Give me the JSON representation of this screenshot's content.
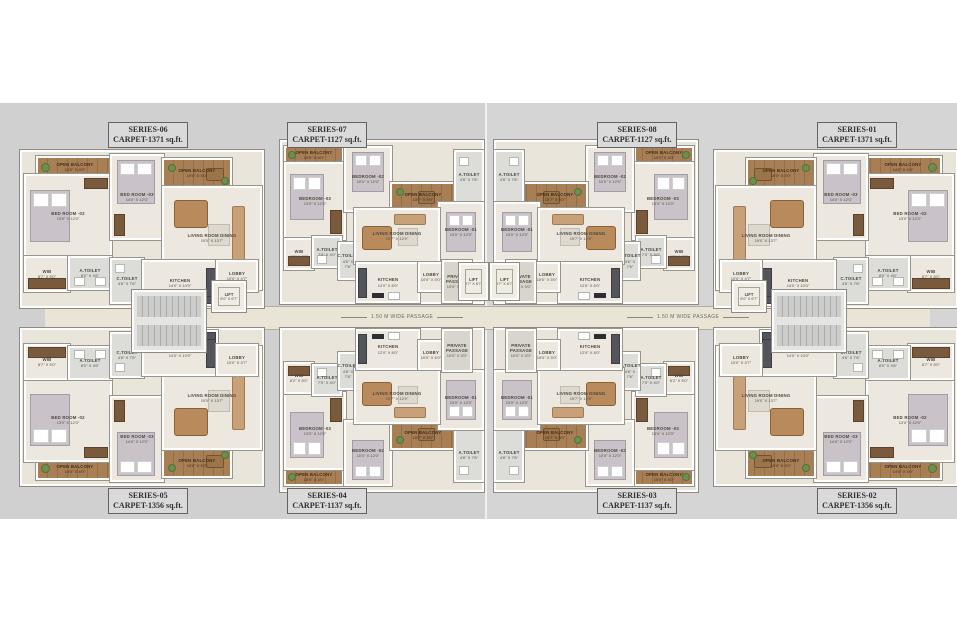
{
  "palette": {
    "page_bg": "#ffffff",
    "canvas_left": "#d0d0d0",
    "canvas_right": "#d5d5d5",
    "floor": "#ece8df",
    "wood_balcony": "#a87e55",
    "corridor": "#e9e4d6",
    "counter_dark": "#53555a",
    "wall": "#fdfdfd",
    "label_text": "#4c483e"
  },
  "passage": {
    "label": "1.50 M WIDE PASSAGE"
  },
  "cores": {
    "lift": {
      "name": "LIFT",
      "dims": "8'0\" X 6'7\""
    },
    "lift_center": {
      "name": "LIFT",
      "dims": "8'7\" X 6'7\""
    }
  },
  "units": [
    {
      "series": "SERIES-06",
      "carpet": "CARPET-1371 sq.ft.",
      "type": "A",
      "flip": "",
      "ux": 20,
      "uy": 150,
      "lx": 108,
      "ly": 122
    },
    {
      "series": "SERIES-07",
      "carpet": "CARPET-1127 sq.ft.",
      "type": "B",
      "flip": "",
      "ux": 280,
      "uy": 140,
      "lx": 287,
      "ly": 122
    },
    {
      "series": "SERIES-08",
      "carpet": "CARPET-1127 sq.ft.",
      "type": "B",
      "flip": "fx",
      "ux": 494,
      "uy": 140,
      "lx": 597,
      "ly": 122
    },
    {
      "series": "SERIES-01",
      "carpet": "CARPET-1371 sq.ft.",
      "type": "A",
      "flip": "fx",
      "ux": 714,
      "uy": 150,
      "lx": 817,
      "ly": 122
    },
    {
      "series": "SERIES-05",
      "carpet": "CARPET-1356 sq.ft.",
      "type": "A",
      "flip": "fy",
      "ux": 20,
      "uy": 328,
      "lx": 108,
      "ly": 488
    },
    {
      "series": "SERIES-04",
      "carpet": "CARPET-1137 sq.ft.",
      "type": "B",
      "flip": "fy",
      "ux": 280,
      "uy": 328,
      "lx": 287,
      "ly": 488
    },
    {
      "series": "SERIES-03",
      "carpet": "CARPET-1137 sq.ft.",
      "type": "B",
      "flip": "fx fy",
      "ux": 494,
      "uy": 328,
      "lx": 597,
      "ly": 488
    },
    {
      "series": "SERIES-02",
      "carpet": "CARPET-1356 sq.ft.",
      "type": "A",
      "flip": "fx fy",
      "ux": 714,
      "uy": 328,
      "lx": 817,
      "ly": 488
    }
  ],
  "unit_types": {
    "A": {
      "w": 240,
      "h": 154,
      "rooms": [
        {
          "n": "OPEN BALCONY",
          "d": "14'0\" X 4'0\"",
          "x": 14,
          "y": 4,
          "w": 74,
          "h": 18,
          "k": "w",
          "f": [
            {
              "k": "plant",
              "x": 3,
              "y": 5,
              "w": 7,
              "h": 7
            }
          ]
        },
        {
          "n": "BED ROOM -02",
          "d": "13'0\" X 12'0\"",
          "x": 2,
          "y": 22,
          "w": 84,
          "h": 80,
          "k": "t",
          "f": [
            {
              "k": "bed",
              "x": 4,
              "y": 14,
              "w": 40,
              "h": 52
            },
            {
              "k": "ward",
              "x": 58,
              "y": 2,
              "w": 22,
              "h": 9
            }
          ]
        },
        {
          "n": "BED ROOM -03",
          "d": "14'0\" X 12'0\"",
          "x": 88,
          "y": 2,
          "w": 50,
          "h": 82,
          "k": "t",
          "f": [
            {
              "k": "bed",
              "x": 5,
              "y": 4,
              "w": 38,
              "h": 44
            },
            {
              "k": "ward",
              "x": 2,
              "y": 58,
              "w": 9,
              "h": 20
            }
          ]
        },
        {
          "n": "OPEN BALCONY",
          "d": "19'0\" X 5'0\"",
          "x": 140,
          "y": 6,
          "w": 66,
          "h": 26,
          "k": "w",
          "f": [
            {
              "k": "plant",
              "x": 4,
              "y": 4,
              "w": 6,
              "h": 6
            },
            {
              "k": "table2",
              "x": 42,
              "y": 8,
              "w": 16,
              "h": 11
            },
            {
              "k": "plant",
              "x": 57,
              "y": 17,
              "w": 6,
              "h": 6
            }
          ]
        },
        {
          "n": "LIVING ROOM DINING",
          "d": "19'0\" X 13'7\"",
          "x": 140,
          "y": 34,
          "w": 96,
          "h": 100,
          "k": "t",
          "f": [
            {
              "k": "dining",
              "x": 10,
              "y": 12,
              "w": 32,
              "h": 26
            },
            {
              "k": "sofa",
              "x": 68,
              "y": 18,
              "w": 11,
              "h": 54
            },
            {
              "k": "rug",
              "x": 44,
              "y": 36,
              "w": 20,
              "h": 20
            }
          ]
        },
        {
          "n": "WIB",
          "d": "8'7\" X 5'0\"",
          "x": 2,
          "y": 104,
          "w": 42,
          "h": 32,
          "k": "t",
          "f": [
            {
              "k": "ward",
              "x": 2,
              "y": 20,
              "w": 36,
              "h": 9
            }
          ]
        },
        {
          "n": "A.TOILET",
          "d": "8'0\" X 4'6\"",
          "x": 46,
          "y": 104,
          "w": 40,
          "h": 30,
          "k": "s",
          "f": [
            {
              "k": "fix",
              "x": 4,
              "y": 19,
              "w": 9,
              "h": 7
            },
            {
              "k": "fix",
              "x": 25,
              "y": 19,
              "w": 9,
              "h": 7
            }
          ]
        },
        {
          "n": "C.TOILET",
          "d": "4'6\" X 7'6\"",
          "x": 88,
          "y": 106,
          "w": 30,
          "h": 42,
          "k": "s",
          "f": [
            {
              "k": "fix",
              "x": 3,
              "y": 4,
              "w": 8,
              "h": 7
            }
          ]
        },
        {
          "n": "KITCHEN",
          "d": "14'0\" X 10'0\"",
          "x": 120,
          "y": 108,
          "w": 72,
          "h": 42,
          "k": "t",
          "f": [
            {
              "k": "counter",
              "x": 0,
              "y": 33,
              "w": 70,
              "h": 7
            },
            {
              "k": "counter",
              "x": 62,
              "y": 6,
              "w": 8,
              "h": 27
            },
            {
              "k": "stove",
              "x": 28,
              "y": 34,
              "w": 14,
              "h": 5
            }
          ]
        },
        {
          "n": "LOBBY",
          "d": "10'0\" X 4'7\"",
          "x": 194,
          "y": 108,
          "w": 38,
          "h": 28,
          "k": "t",
          "f": []
        }
      ]
    },
    "B": {
      "w": 200,
      "h": 160,
      "rooms": [
        {
          "n": "OPEN BALCONY",
          "d": "10'0\" X 4'0\"",
          "x": 2,
          "y": 4,
          "w": 56,
          "h": 14,
          "k": "w",
          "f": [
            {
              "k": "plant",
              "x": 2,
              "y": 3,
              "w": 6,
              "h": 6
            }
          ]
        },
        {
          "n": "BEDROOM -03",
          "d": "13'0\" X 12'0\"",
          "x": 2,
          "y": 20,
          "w": 58,
          "h": 74,
          "k": "t",
          "f": [
            {
              "k": "bed",
              "x": 4,
              "y": 10,
              "w": 34,
              "h": 46
            },
            {
              "k": "ward",
              "x": 44,
              "y": 46,
              "w": 10,
              "h": 22
            }
          ]
        },
        {
          "n": "BEDROOM -02",
          "d": "10'0\" X 12'0\"",
          "x": 62,
          "y": 4,
          "w": 44,
          "h": 62,
          "k": "t",
          "f": [
            {
              "k": "bed",
              "x": 6,
              "y": 4,
              "w": 32,
              "h": 40
            }
          ]
        },
        {
          "n": "OPEN BALCONY",
          "d": "15'7\" X 5'0\"",
          "x": 108,
          "y": 40,
          "w": 62,
          "h": 26,
          "k": "w",
          "f": [
            {
              "k": "table2",
              "x": 26,
              "y": 7,
              "w": 15,
              "h": 11
            },
            {
              "k": "plant",
              "x": 4,
              "y": 4,
              "w": 6,
              "h": 6
            }
          ]
        },
        {
          "n": "A.TOILET",
          "d": "4'6\" X 7'6\"",
          "x": 172,
          "y": 8,
          "w": 26,
          "h": 50,
          "k": "s",
          "f": [
            {
              "k": "fix",
              "x": 3,
              "y": 5,
              "w": 8,
              "h": 7
            }
          ]
        },
        {
          "n": "BEDROOM -01",
          "d": "10'0\" X 12'0\"",
          "x": 156,
          "y": 60,
          "w": 42,
          "h": 56,
          "k": "t",
          "f": [
            {
              "k": "bed",
              "x": 6,
              "y": 8,
              "w": 30,
              "h": 40
            }
          ]
        },
        {
          "n": "WIB",
          "d": "6'2\" X 5'0\"",
          "x": 2,
          "y": 96,
          "w": 26,
          "h": 28,
          "k": "t",
          "f": [
            {
              "k": "ward",
              "x": 2,
              "y": 16,
              "w": 20,
              "h": 8
            }
          ]
        },
        {
          "n": "A.TOILET",
          "d": "7'0\" X 4'0\"",
          "x": 30,
          "y": 94,
          "w": 26,
          "h": 28,
          "k": "s",
          "f": [
            {
              "k": "fix",
              "x": 3,
              "y": 17,
              "w": 8,
              "h": 7
            }
          ]
        },
        {
          "n": "C.TOILET",
          "d": "4'6\" X 7'6\"",
          "x": 56,
          "y": 100,
          "w": 16,
          "h": 34,
          "k": "s",
          "f": []
        },
        {
          "n": "LIVING ROOM DINING",
          "d": "19'7\" X 12'0\"",
          "x": 72,
          "y": 66,
          "w": 82,
          "h": 52,
          "k": "t",
          "f": [
            {
              "k": "dining",
              "x": 6,
              "y": 16,
              "w": 28,
              "h": 22
            },
            {
              "k": "sofah",
              "x": 38,
              "y": 4,
              "w": 30,
              "h": 9
            },
            {
              "k": "rug",
              "x": 42,
              "y": 18,
              "w": 18,
              "h": 16
            }
          ]
        },
        {
          "n": "KITCHEN",
          "d": "12'0\" X 8'0\"",
          "x": 74,
          "y": 120,
          "w": 60,
          "h": 37,
          "k": "t",
          "f": [
            {
              "k": "counter",
              "x": 0,
              "y": 4,
              "w": 7,
              "h": 28
            },
            {
              "k": "stove",
              "x": 14,
              "y": 29,
              "w": 12,
              "h": 5
            },
            {
              "k": "fix",
              "x": 30,
              "y": 28,
              "w": 10,
              "h": 6
            }
          ]
        },
        {
          "n": "LOBBY",
          "d": "10'0\" X 5'0\"",
          "x": 136,
          "y": 120,
          "w": 22,
          "h": 26,
          "k": "t",
          "f": []
        },
        {
          "n": "PRIVATE PASSAGE",
          "d": "10'0\" X 3'0\"",
          "x": 160,
          "y": 118,
          "w": 26,
          "h": 39,
          "k": "g",
          "f": []
        }
      ]
    }
  }
}
